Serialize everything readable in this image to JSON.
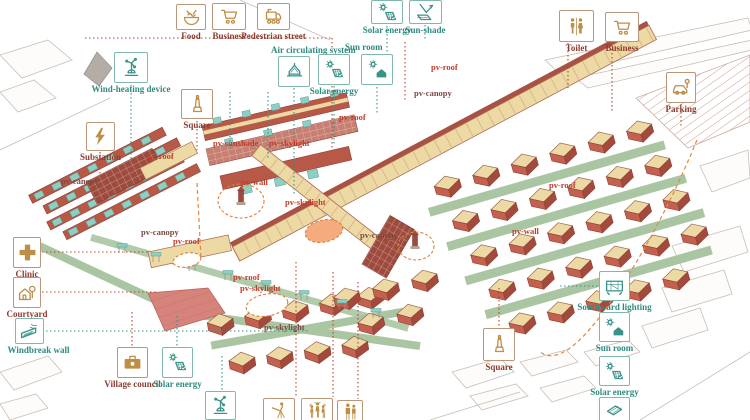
{
  "figure": {
    "type": "axonometric village masterplan diagram",
    "background": "white"
  },
  "palette": {
    "teal_labels": "#2e8b80",
    "brown_labels": "#8e3b2f",
    "tan_icons": "#bf8e46",
    "teal_icons": "#3a9188",
    "pv_red": "#c13b2a",
    "pv_dark": "#7c4a42",
    "roof_beige": "#ecd9a4",
    "brick_red": "#b85948",
    "dark_lattice": "#9e4b3d",
    "pv_panel_teal": "#8ecfc4",
    "path_green": "#aac5a2",
    "highlight_orange": "#e8853a",
    "plaza_orange_fill": "#f5ab7e"
  },
  "callouts": [
    {
      "id": "food",
      "label": "Food",
      "theme": "brown",
      "icon": "food-bowl"
    },
    {
      "id": "business-top-left",
      "label": "Business",
      "theme": "brown",
      "icon": "shopping-cart"
    },
    {
      "id": "pedestrian-street",
      "label": "Pedestrian street",
      "theme": "brown",
      "icon": "trolley"
    },
    {
      "id": "toilet",
      "label": "Toilet",
      "theme": "brown",
      "icon": "restroom-figures"
    },
    {
      "id": "business-top-right",
      "label": "Business",
      "theme": "brown",
      "icon": "shopping-cart"
    },
    {
      "id": "parking",
      "label": "Parking",
      "theme": "brown",
      "icon": "car-with-meter"
    },
    {
      "id": "square-top",
      "label": "Square",
      "theme": "brown",
      "icon": "monument-tower"
    },
    {
      "id": "substation",
      "label": "Substation",
      "theme": "brown",
      "icon": "lightning-bolt"
    },
    {
      "id": "clinic",
      "label": "Clinic",
      "theme": "brown",
      "icon": "medical-cross"
    },
    {
      "id": "courtyard",
      "label": "Courtyard",
      "theme": "brown",
      "icon": "house-with-tree"
    },
    {
      "id": "village-council",
      "label": "Village council",
      "theme": "brown",
      "icon": "briefcase"
    },
    {
      "id": "air-circulating-system",
      "label": "Air circulating system",
      "theme": "teal",
      "icon": "hanging-canopy"
    },
    {
      "id": "solar-energy-center",
      "label": "Solar energy",
      "theme": "teal",
      "icon": "sun-with-panel"
    },
    {
      "id": "sun-room-center",
      "label": "Sun room",
      "theme": "teal",
      "icon": "sun-with-house"
    },
    {
      "id": "solar-energy-top",
      "label": "Solar energy",
      "theme": "teal",
      "icon": "sun-with-panel"
    },
    {
      "id": "sun-shade",
      "label": "Sun-shade",
      "theme": "teal",
      "icon": "panel-with-arrow"
    },
    {
      "id": "wind-heating-device",
      "label": "Wind-heating device",
      "theme": "teal",
      "icon": "windmill"
    },
    {
      "id": "windbreak-wall",
      "label": "Windbreak wall",
      "theme": "teal",
      "icon": "slanted-wall-wind"
    },
    {
      "id": "solar-energy-bottom-left",
      "label": "Solar energy",
      "theme": "teal",
      "icon": "sun-with-panel"
    },
    {
      "id": "southward-lighting",
      "label": "Southward lighting",
      "theme": "teal",
      "icon": "window-grid"
    },
    {
      "id": "sun-room-right",
      "label": "Sun room",
      "theme": "teal",
      "icon": "sun-with-house"
    },
    {
      "id": "solar-energy-right",
      "label": "Solar energy",
      "theme": "teal",
      "icon": "sun-with-panel"
    },
    {
      "id": "square-bottom",
      "label": "Square",
      "theme": "brown",
      "icon": "monument-tower"
    },
    {
      "id": "wind-device-bottom",
      "label": "",
      "theme": "teal",
      "icon": "windmill"
    },
    {
      "id": "telescope-bottom",
      "label": "",
      "theme": "brown",
      "icon": "person-telescope"
    },
    {
      "id": "people-bottom",
      "label": "",
      "theme": "brown",
      "icon": "people-group"
    },
    {
      "id": "family-bottom",
      "label": "",
      "theme": "brown",
      "icon": "people-pair"
    },
    {
      "id": "teal-bottom-right",
      "label": "",
      "theme": "teal",
      "icon": "panel-lines"
    }
  ],
  "pv_labels": [
    {
      "text": "pv-roof"
    },
    {
      "text": "pv-sunshade"
    },
    {
      "text": "pv-skylight"
    },
    {
      "text": "pv-wall"
    },
    {
      "text": "pv-roof"
    },
    {
      "text": "pv-canopy"
    },
    {
      "text": "pv-roof"
    },
    {
      "text": "pv-canopy"
    },
    {
      "text": "pv-canopy"
    },
    {
      "text": "pv-roof"
    },
    {
      "text": "pv-skylight"
    },
    {
      "text": "pv-canopy"
    },
    {
      "text": "pv-roof"
    },
    {
      "text": "pv-skylight"
    },
    {
      "text": "pv-skylight"
    },
    {
      "text": "pv-roof"
    },
    {
      "text": "pv-wall"
    }
  ]
}
